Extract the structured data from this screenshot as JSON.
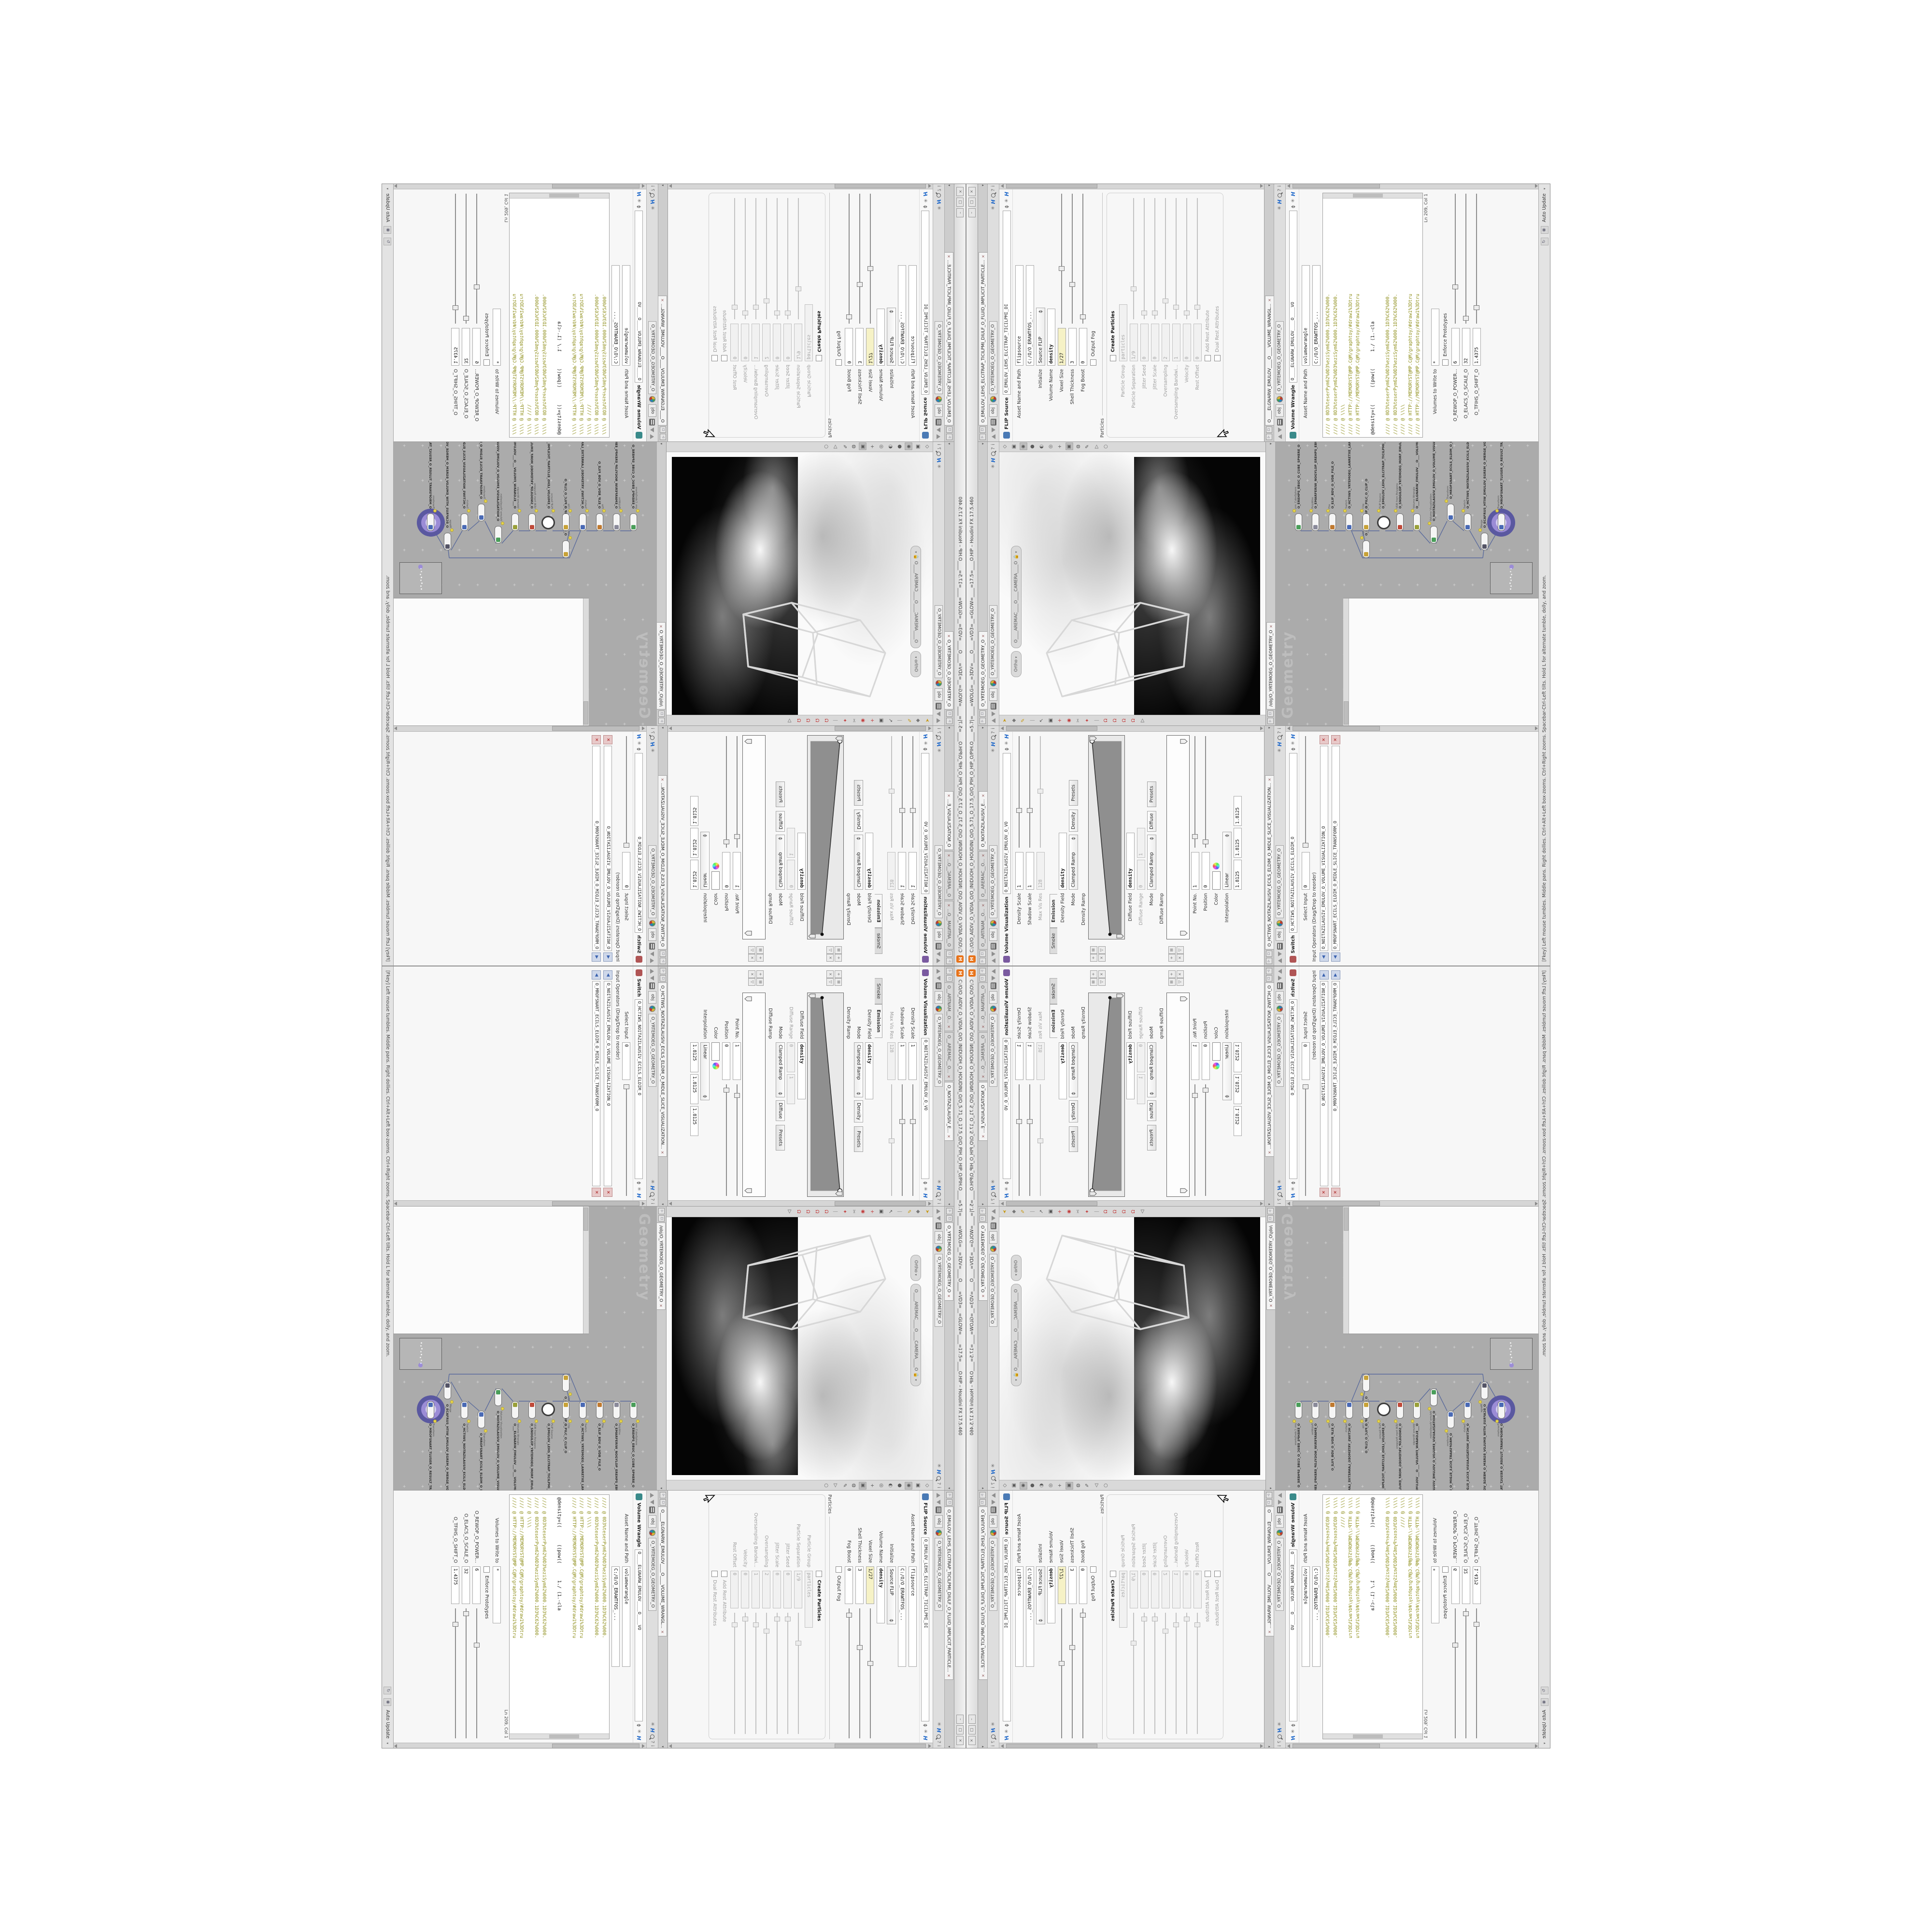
{
  "window": {
    "title": "C:/O/O_AIDIV_O_VIDIA_O/O_INIDUOH_O_HOUDINI_O/O_5.71_O_17.5_O/O_PIH_O_HIP_O/PIH.O____=5.7|=____=WOLG=__=3DV=____O____=VD3=__=GLOW=____=17.5=____O.HIP – Houdini FX 17.5.460",
    "logo": "H",
    "buttons": [
      "–",
      "□",
      "×"
    ]
  },
  "statusbar": {
    "help": "[Fkey] Left mouse tumbles. Middle pans. Right dollies. Ctrl+Alt+Left box-zooms. Ctrl+Right zooms. Spacebar-Ctrl-Left tilts. Hold L for alternate tumble, dolly, and zoom.",
    "icons": [
      "↻",
      "◉"
    ],
    "auto_update": "Auto Update"
  },
  "breadcrumb": {
    "context": "obj",
    "node": "O_YRTEMOEG_O_GEOMETRY_O"
  },
  "colors": {
    "accent_purple": "#5a58a0",
    "network_bg": "#ababab",
    "expr_yellow": "#f6f2c6",
    "code_olive": "#8f8f1b",
    "code_teal": "#2d8f8f",
    "logo_orange": "#e8731a"
  },
  "panes": {
    "volviz": {
      "tabs": [
        {
          "label": "O__ARTNAM__O...",
          "active": false
        },
        {
          "label": "O__AREMAC__O...",
          "active": false
        },
        {
          "label": "O_NOITAZILAUSIV_E...",
          "active": true
        }
      ],
      "header": {
        "type": "Volume Visualization",
        "name": "O_NOITAZILAUSIV_EMULOV_O_VO",
        "icon": "#7a5aa0"
      },
      "rows": [
        {
          "t": "field",
          "label": "Density Scale",
          "value": "1",
          "slider": 0.33
        },
        {
          "t": "field",
          "label": "Shadow Scale",
          "value": "1",
          "slider": 0.33
        },
        {
          "t": "field",
          "label": "Max Vis Res",
          "value": "128",
          "dis": true,
          "slider": 0.5
        },
        {
          "t": "ftabs",
          "opts": [
            "Smoke",
            "Emission"
          ],
          "active": 1
        },
        {
          "t": "field",
          "label": "Density Field",
          "value": "density",
          "bold": true,
          "w": 110
        },
        {
          "t": "mode",
          "label": "Mode",
          "value": "Clamped Ramp",
          "chip": "Density",
          "btn": "Presets"
        },
        {
          "t": "ramplabel",
          "label": "Density Ramp"
        },
        {
          "t": "ramp",
          "kind": "density"
        },
        {
          "t": "field",
          "label": "Diffuse Field",
          "value": "density",
          "bold": true,
          "w": 110
        },
        {
          "t": "pair",
          "label": "Diffuse Range",
          "values": [
            "0",
            "1"
          ],
          "dis": true
        },
        {
          "t": "mode",
          "label": "Mode",
          "value": "Clamped Ramp",
          "chip": "Diffuse",
          "btn": "Presets"
        },
        {
          "t": "ramplabel",
          "label": "Diffuse Ramp"
        },
        {
          "t": "ramp",
          "kind": "diffuse"
        },
        {
          "t": "field",
          "label": "Point No.",
          "value": "1",
          "slider": 0.1
        },
        {
          "t": "field",
          "label": "Position",
          "value": "0",
          "slider": 0.05
        },
        {
          "t": "color",
          "label": "Color"
        },
        {
          "t": "drop",
          "label": "Interpolation",
          "value": "Linear"
        },
        {
          "t": "triple",
          "label": "",
          "values": [
            "1.8125",
            "1.8125",
            "1.8125"
          ]
        }
      ]
    },
    "switch": {
      "tabs": [
        {
          "label": "O_HCTIWS_NOITAZILAUSIV_ECILS_ELDIM_O_MIDLE_SLICE_VISUALIZATION...",
          "active": true
        }
      ],
      "header": {
        "type": "Switch",
        "name": "O_HCTIWS_NOITAZILAUSIV_ECILS_ELDIM_O",
        "icon": "#b05555"
      },
      "rows": [
        {
          "t": "field",
          "label": "Select Input",
          "value": "0",
          "slider": 0.02
        },
        {
          "t": "listlabel",
          "label": "Input Operators (Drag/Drop to reorder)"
        },
        {
          "t": "listrow",
          "value": "O_NOITAZILAUSIV_EMULOV_O_VOLUME_VISUALIZATION_O"
        },
        {
          "t": "listrow",
          "value": "O_MROFSNART_ECILS_ELDIM_O_MIDLE_SLICE_TRANSFORM_O"
        }
      ]
    },
    "flip": {
      "tabs": [
        {
          "label": "O_EMULOV_LEHS_ELCITRAP_TICILPMI_DIULF_O_FLUID_IMPLICIT_PARTICLE...",
          "active": true
        }
      ],
      "header": {
        "type": "FLIP Source",
        "name": "O_EMULOV_LEHS_ELCITRAP_TICILPMI_DI",
        "icon": "#4a7ab5"
      },
      "rows": [
        {
          "t": "asset",
          "label": "Asset Name and Path",
          "v1": "flipsource",
          "v2": "C:/O/O_ERAWTFOS_..."
        },
        {
          "t": "drop",
          "label": "Initialize",
          "value": "Source FLIP"
        },
        {
          "t": "field",
          "label": "Volume Name",
          "value": "density",
          "bold": true,
          "w": 110
        },
        {
          "t": "field",
          "label": "Voxel Size",
          "value": "1/27",
          "yellow": true,
          "slider": 0.42
        },
        {
          "t": "field",
          "label": "Shell Thickness",
          "value": "3",
          "slider": 0.3
        },
        {
          "t": "field",
          "label": "Fog Boost",
          "value": "0",
          "slider": 0.05
        },
        {
          "t": "check",
          "label": "Output Fog"
        },
        {
          "t": "section",
          "label": "Particles"
        },
        {
          "t": "check",
          "label": "Create Particles",
          "bold": true
        },
        {
          "t": "field",
          "label": "Particle Group",
          "value": "particles",
          "dis": true,
          "w": 110
        },
        {
          "t": "field",
          "label": "Particle Separation",
          "value": "1/9",
          "dis": true,
          "slider": 0.25
        },
        {
          "t": "field",
          "label": "Jitter Seed",
          "value": "0",
          "dis": true,
          "slider": 0.05
        },
        {
          "t": "field",
          "label": "Jitter Scale",
          "value": "0",
          "dis": true,
          "slider": 0.05
        },
        {
          "t": "field",
          "label": "Oversampling",
          "value": "2",
          "dis": true,
          "slider": 0.15
        },
        {
          "t": "field",
          "label": "Oversampling Bandwi...",
          "value": "1",
          "dis": true,
          "slider": 0.1
        },
        {
          "t": "field",
          "label": "Velocity",
          "value": "0",
          "dis": true,
          "slider": 0.05
        },
        {
          "t": "field",
          "label": "Rest Offset",
          "value": "0",
          "dis": true,
          "slider": 0.1
        },
        {
          "t": "check",
          "label": "Add Rest Attribute",
          "dis": true
        },
        {
          "t": "check",
          "label": "Dual Rest Attributes",
          "dis": true,
          "cursor": true
        }
      ]
    },
    "wrangle": {
      "tabs": [
        {
          "label": "O____ELGNARW_EMULOV____O____VOLUME_WRANGL...",
          "active": true
        }
      ],
      "header": {
        "type": "Volume Wrangle",
        "name": "O____ELGNARW_EMULOV____O____VO",
        "icon": "#3a8a8a"
      },
      "rows": [
        {
          "t": "asset",
          "label": "Asset Name and Path",
          "v1": "volumewrangle",
          "v2": "C:/O/O_ERAWTFOS_..."
        },
        {
          "t": "code",
          "status": "Ln 209, Col 1",
          "lines": [
            {
              "c": "olive",
              "t": "//// @ 0D3%teserPym62%0D3%eziSym62%000.1D3%C62%000."
            },
            {
              "c": "olive",
              "t": "//// @ 0D3%teserPym62%0D3%eziSym62%000.1D3%C62%000."
            },
            {
              "c": "olive",
              "t": "//// @ \\\\\\\\"
            },
            {
              "c": "olive",
              "t": "//// @ HTTP://MEMORYST@MP.C@M/graphtoy/#draw1%3Dtru"
            },
            {
              "c": "olive",
              "t": "//// @ HTTP://MEMORYST@MP.C@M/graphtoy/#draw1%3Dtru"
            },
            {
              "c": "code",
              "t": ""
            },
            {
              "c": "code",
              "t": "@density=((      ((pow((      1./ (1.-cla"
            },
            {
              "c": "code",
              "t": ""
            },
            {
              "c": "olive",
              "t": "//// @ 0D3%teserPym62%0D3%eziSym62%000.1D3%C62%000."
            },
            {
              "c": "olive",
              "t": "//// @ 0D3%teserPym62%0D3%eziSym62%000.1D3%C62%000."
            },
            {
              "c": "olive",
              "t": "//// @ \\\\\\\\"
            },
            {
              "c": "olive",
              "t": "//// @ HTTP://MEMORYST@MP.C@M/graphtoy/#draw1%3Dtru"
            },
            {
              "c": "olive",
              "t": "//// @ HTTP://MEMORYST@MP.C@M/graphtoy/#draw1%3Dtru"
            }
          ]
        },
        {
          "t": "field",
          "label": "Volumes to Write to",
          "value": "*",
          "w": 110
        },
        {
          "t": "check",
          "label": "Enforce Prototypes"
        },
        {
          "t": "field",
          "label": "O_REWOP_O_POWER...",
          "value": "6",
          "slider": 0.28
        },
        {
          "t": "field",
          "label": "O_ELACS_O_SCALE_O",
          "value": "32",
          "slider": 0.04
        },
        {
          "t": "field",
          "label": "O_TFIHS_O_SHIFT_O",
          "value": "1.4375",
          "slider": 0.12
        }
      ]
    },
    "viewport": {
      "tabs": [
        {
          "label": "O_YRTEMOEG_O_GEOMETRY_O",
          "active": true
        }
      ],
      "pills": {
        "view": "Ortho",
        "camera": "O____AREMAC____O____CAMERA____O"
      },
      "toolbar_right": [
        "◇",
        "▣",
        "◉",
        "●",
        "◐",
        "◎",
        "+",
        "▣",
        "◍",
        "✎",
        "▷",
        "○"
      ],
      "toolbar_right_pressed": [
        2,
        7
      ],
      "toolbar_left": [
        {
          "g": "➤",
          "c": "#c79a17"
        },
        {
          "g": "◆",
          "c": "#777"
        },
        {
          "g": "✎",
          "c": "#c79a17"
        },
        {
          "g": "|",
          "c": "#999"
        },
        {
          "g": "↖",
          "c": "#555"
        },
        {
          "g": "▣",
          "c": "#555"
        },
        {
          "g": "+",
          "c": "#c23a3a"
        },
        {
          "g": "◉",
          "c": "#c23a3a"
        },
        {
          "g": "✂",
          "c": "#777"
        },
        {
          "g": "✦",
          "c": "#c23a3a"
        },
        {
          "g": "|",
          "c": "#999"
        },
        {
          "g": "Ω",
          "c": "#c23a3a"
        },
        {
          "g": "Ω",
          "c": "#c23a3a"
        },
        {
          "g": "Ω",
          "c": "#c23a3a"
        },
        {
          "g": "Ω",
          "c": "#c23a3a"
        },
        {
          "g": "▷",
          "c": "#555"
        }
      ]
    },
    "network": {
      "tabs": [
        {
          "label": "/obj/O_YRTEMOEG_O_GEOMETRY_O",
          "active": true
        }
      ],
      "watermark": "Geometry",
      "nodes": [
        {
          "type": "pm_CubeSphere",
          "name": "O_EREHPS_EBUC_O_CUBE_SPHERE_O",
          "color": "#4a9e5a"
        },
        {
          "type": "PolyWire",
          "name": "O_EMARFERIW_NOGYLOP_EREHPS_EBUC_O_CUBE_SPHERE_POLYGON_WIREFRAME_O",
          "color": "#8a8a9a"
        },
        {
          "type": "File",
          "name": "O_ELIF_BDV_O_VDB_FILE_O",
          "color": "#c07a30"
        },
        {
          "type": "Switch",
          "name": "O_HCTIWS_YRTEMOEG_LANRETXE_LANRETNI_O_INTERNAL_EXTERNAL_GEOMETRY_SWITCH_O",
          "color": "#4a6ab5"
        },
        {
          "type": "Clip",
          "name": "O_PILC_O_CLIP_O",
          "color": "#c8a238",
          "branch": true
        },
        {
          "type": "Clip",
          "name": "O_PILC_O_CLIP_O",
          "color": "#c8a238"
        },
        {
          "type": "FLIP Source",
          "name": "O_EMULOV_LEHS_ELCITRAP_TICILPMI_DIULF_O_FLUID_IMPLICIT_PARTICLE_SHEL_VOLUME_O",
          "color": "#ffffff",
          "circle": true
        },
        {
          "type": "VDB from Polygons",
          "name": "O_SNOGILOP_YRTEMOEG_MORF_EMULOV_BDV_O_VDB_VOLUME_FROM_GEOMETRY_POLYGONS_O",
          "color": "#c04a3a"
        },
        {
          "type": "Volume Wrangle",
          "name": "O___ELGNARW_EMULOV___O___VOLUME_WRANGLE___O",
          "color": "#9aa03a"
        },
        {
          "type": "Volume Visualization",
          "name": "O_NOITAZILAUSIV_EMULOV_O_VOLUME_VISUALIZATION_O",
          "color": "#4a9e5a",
          "off": -26
        },
        {
          "type": "Transform",
          "name": "O_MROFSNART_ECILS_ELDIM_O_MIDLE_SLICE_TRANSFORM_O",
          "color": "#4a6ab5",
          "off": 20,
          "pair": true
        },
        {
          "type": "Switch",
          "name": "O_HCTIWS_NOITAZILAUSIV_ECILS_ELDIM_O_MIDLE_SLICE_VISUALIZATION_SWITCH_O",
          "color": "#4a6ab5"
        },
        {
          "type": "Merge",
          "name": "O_ECAFRUS_HTIW_EMULOV_EGREM_O_MERGE_VOLUME_WITH_SURFACE_O",
          "color": "#555566",
          "off": -40
        },
        {
          "type": "Transform",
          "name": "O_MROFSNART_TLUSER_O_RESULT_TRANSFORM_O",
          "color": "#4a6ab5",
          "ring": true
        }
      ]
    }
  }
}
